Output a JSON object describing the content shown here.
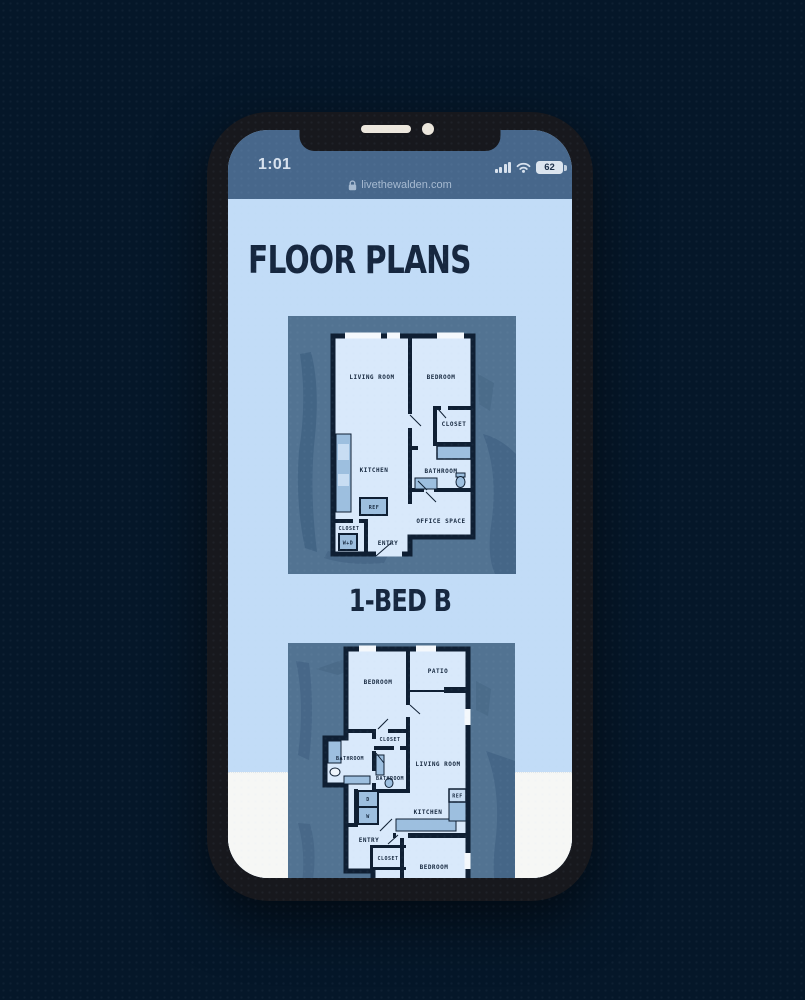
{
  "status_bar": {
    "time": "1:01",
    "battery_level": "62"
  },
  "url_bar": {
    "domain": "livethewalden.com"
  },
  "page": {
    "title": "FLOOR PLANS",
    "section_label": "1-BED B"
  },
  "floorplan_a": {
    "labels": {
      "living_room": "LIVING ROOM",
      "bedroom": "BEDROOM",
      "closet_upper": "CLOSET",
      "kitchen": "KITCHEN",
      "bathroom": "BATHROOM",
      "ref": "REF",
      "office_space": "OFFICE SPACE",
      "closet_lower": "CLOSET",
      "entry": "ENTRY",
      "washer_dryer": "W+D"
    }
  },
  "floorplan_b": {
    "labels": {
      "bedroom_upper": "BEDROOM",
      "patio": "PATIO",
      "closet_mid": "CLOSET",
      "bathroom_1": "BATHROOM",
      "living_room": "LIVING ROOM",
      "bathroom_2": "BATHROOM",
      "dryer": "D",
      "washer": "W",
      "ref": "REF",
      "kitchen": "KITCHEN",
      "entry": "ENTRY",
      "closet_lower": "CLOSET",
      "bedroom_lower": "BEDROOM"
    }
  },
  "colors": {
    "page_background": "#051729",
    "phone_bezel": "#17181d",
    "status_bar": "#47678b",
    "screen_background": "#c2dcf7",
    "white_band": "#f6f7f5",
    "heading_text": "#16273f",
    "card_background": "#527392",
    "plan_fill": "#d9e9fb",
    "plan_walls": "#0f1f33",
    "plan_fixtures": "#9dbfdf"
  },
  "icons": {
    "cellular": "cellular-signal-icon",
    "wifi": "wifi-icon",
    "battery": "battery-icon",
    "lock": "lock-icon"
  }
}
